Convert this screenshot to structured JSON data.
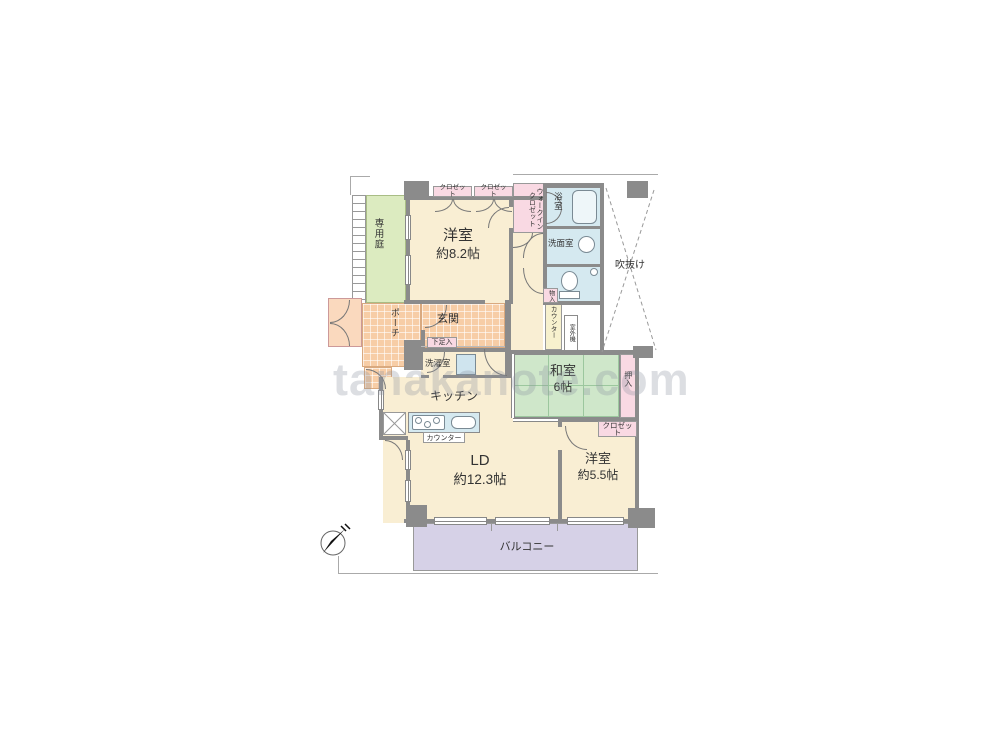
{
  "floorplan": {
    "watermark": "tanakanote.com",
    "compass_n": "N",
    "garden": "専用庭",
    "porch": "ポーチ",
    "entrance": "玄関",
    "shoe_cabinet": "下足入",
    "bedroom1_name": "洋室",
    "bedroom1_size": "約8.2帖",
    "closet_a": "クロゼット",
    "closet_b": "クロゼット",
    "walkin_closet": "ウォークインクロゼット",
    "bathroom": "浴室",
    "washroom": "洗面室",
    "void_space": "吹抜け",
    "storage": "物入",
    "hall_counter": "カウンター",
    "outdoor_unit": "室外機",
    "laundry": "洗濯室",
    "kitchen": "キッチン",
    "kitchen_counter": "カウンター",
    "washitsu_name": "和室",
    "washitsu_size": "6帖",
    "oshiire": "押入",
    "closet_c": "クロゼット",
    "living_name": "LD",
    "living_size": "約12.3帖",
    "bedroom2_name": "洋室",
    "bedroom2_size": "約5.5帖",
    "balcony": "バルコニー",
    "colors": {
      "wall": "#8b8b8b",
      "room_cream": "#f9eed3",
      "closet_pink": "#f9d9e3",
      "wet_blue": "#d5e9f0",
      "tatami_green": "#cfe7ca",
      "garden_green": "#dcebc0",
      "balcony_lavender": "#d6d1e7",
      "tile_orange": "#f7cda6"
    }
  }
}
